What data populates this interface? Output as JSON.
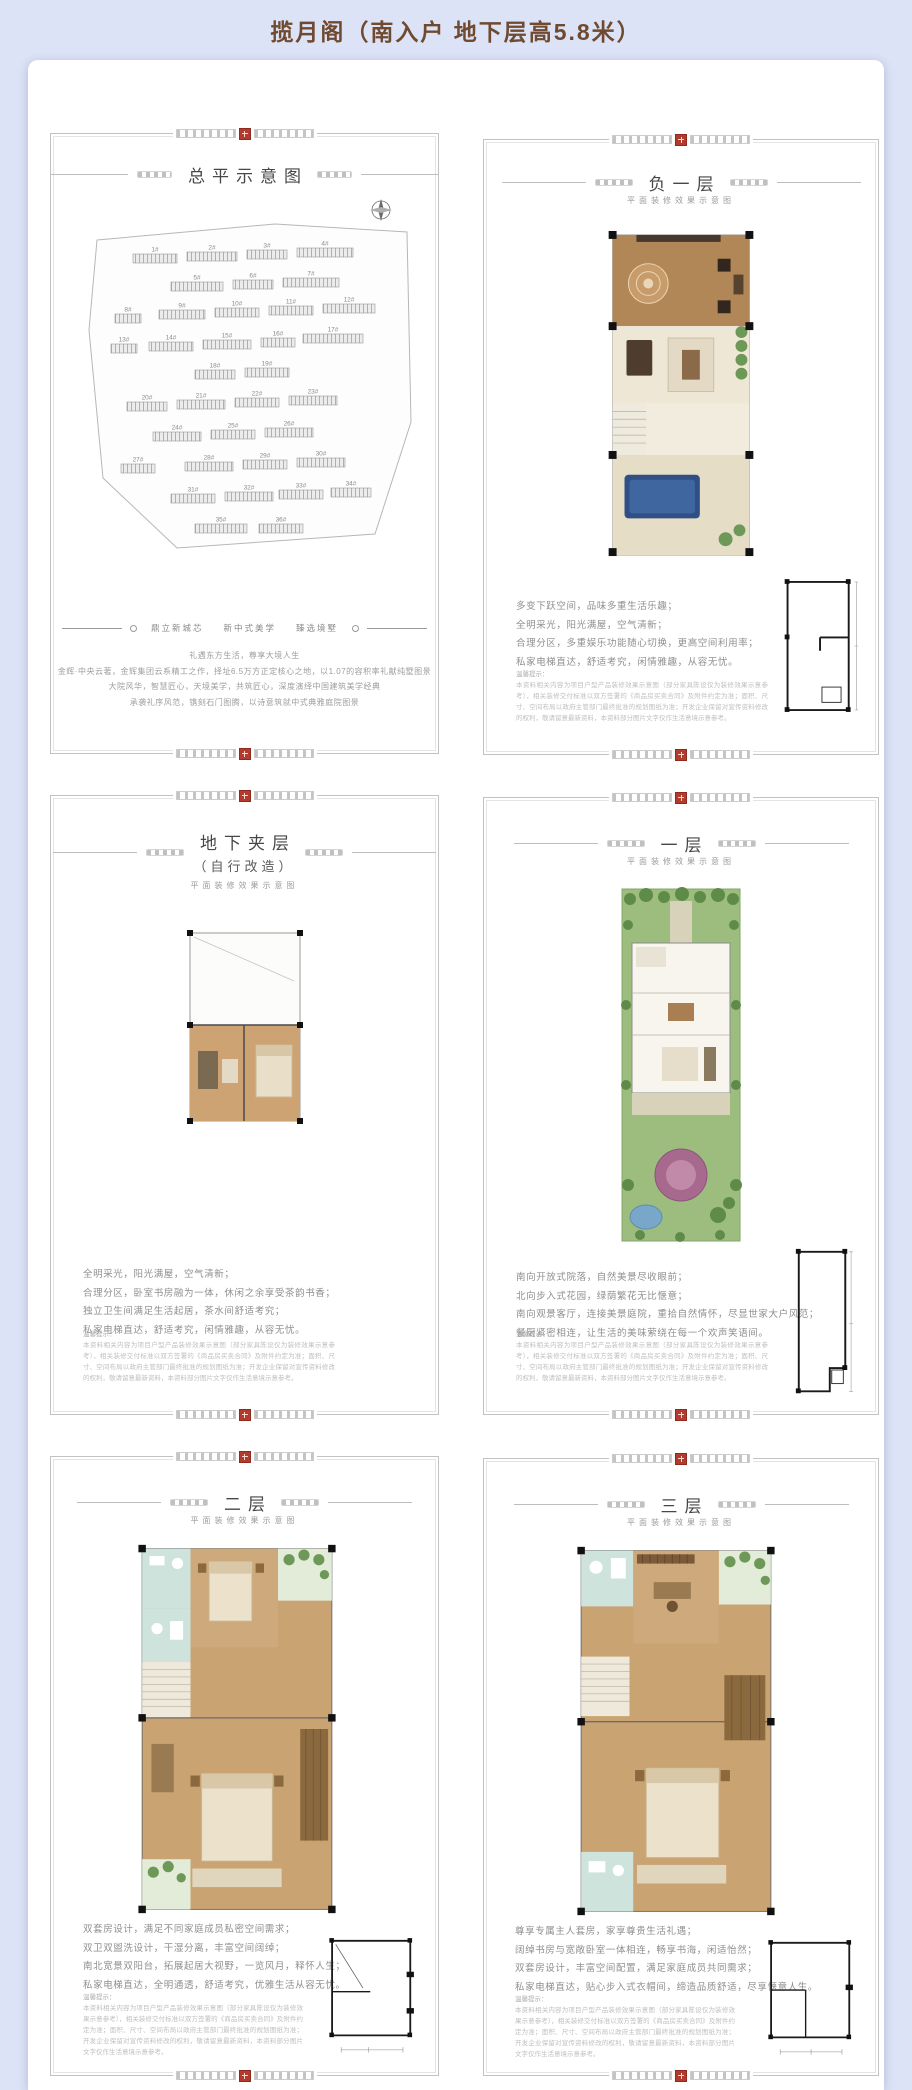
{
  "page": {
    "header_title": "揽月阁（南入户 地下层高5.8米）"
  },
  "colors": {
    "background_lavender": "#dce3f6",
    "header_brown": "#6f4a31",
    "seal_red": "#b23b2e",
    "panel_border_gray": "#c2c2c2",
    "pool_blue": "#2f4f86",
    "garden_green": "#9dbd7f"
  },
  "common": {
    "plan_subtitle": "平面装修效果示意图",
    "notice_title": "温馨提示：",
    "notice_body": "本资料相关内容为项目户型产品装修效果示意图（部分家具陈设仅为装修效果示意参考），相关装修交付标准以双方签署的《商品房买卖合同》及附件约定为准；面积、尺寸、空间布局以政府主管部门最终批准的规划图纸为准；开发企业保留对宣传资料修改的权利，敬请留意最新资料，本资料部分图片文字仅作生活意境示意参考。"
  },
  "site_plan": {
    "title": "总平示意图",
    "compass": "compass-rose-icon",
    "tagline": [
      "鼎立新城芯",
      "新中式美学",
      "臻选境墅"
    ],
    "paragraph": [
      "礼遇东方生活，尊享大境人生",
      "金辉·中央云著，金辉集团云系精工之作，择址6.5万方正定核心之地，以1.07的容积率礼献纯墅图景",
      "大院风华，智慧匠心，天境美学，共筑匠心，深度演绎中国建筑美学经典",
      "承袭礼序风范，镌刻石门图腾，以诗意筑就中式典雅庭院图景"
    ],
    "buildings": [
      {
        "label": "1#",
        "x": 58,
        "y": 72,
        "w": 44
      },
      {
        "label": "2#",
        "x": 112,
        "y": 70,
        "w": 50
      },
      {
        "label": "3#",
        "x": 172,
        "y": 68,
        "w": 40
      },
      {
        "label": "4#",
        "x": 222,
        "y": 66,
        "w": 56
      },
      {
        "label": "5#",
        "x": 96,
        "y": 100,
        "w": 52
      },
      {
        "label": "6#",
        "x": 158,
        "y": 98,
        "w": 40
      },
      {
        "label": "7#",
        "x": 208,
        "y": 96,
        "w": 56
      },
      {
        "label": "8#",
        "x": 40,
        "y": 132,
        "w": 26
      },
      {
        "label": "9#",
        "x": 84,
        "y": 128,
        "w": 46
      },
      {
        "label": "10#",
        "x": 140,
        "y": 126,
        "w": 44
      },
      {
        "label": "11#",
        "x": 194,
        "y": 124,
        "w": 44
      },
      {
        "label": "12#",
        "x": 248,
        "y": 122,
        "w": 52
      },
      {
        "label": "13#",
        "x": 36,
        "y": 162,
        "w": 26
      },
      {
        "label": "14#",
        "x": 74,
        "y": 160,
        "w": 44
      },
      {
        "label": "15#",
        "x": 128,
        "y": 158,
        "w": 48
      },
      {
        "label": "16#",
        "x": 186,
        "y": 156,
        "w": 34
      },
      {
        "label": "17#",
        "x": 228,
        "y": 152,
        "w": 60
      },
      {
        "label": "18#",
        "x": 120,
        "y": 188,
        "w": 40
      },
      {
        "label": "19#",
        "x": 170,
        "y": 186,
        "w": 44
      },
      {
        "label": "20#",
        "x": 52,
        "y": 220,
        "w": 40
      },
      {
        "label": "21#",
        "x": 102,
        "y": 218,
        "w": 48
      },
      {
        "label": "22#",
        "x": 160,
        "y": 216,
        "w": 44
      },
      {
        "label": "23#",
        "x": 214,
        "y": 214,
        "w": 48
      },
      {
        "label": "24#",
        "x": 78,
        "y": 250,
        "w": 48
      },
      {
        "label": "25#",
        "x": 136,
        "y": 248,
        "w": 44
      },
      {
        "label": "26#",
        "x": 190,
        "y": 246,
        "w": 48
      },
      {
        "label": "27#",
        "x": 46,
        "y": 282,
        "w": 34
      },
      {
        "label": "28#",
        "x": 110,
        "y": 280,
        "w": 48
      },
      {
        "label": "29#",
        "x": 168,
        "y": 278,
        "w": 44
      },
      {
        "label": "30#",
        "x": 222,
        "y": 276,
        "w": 48
      },
      {
        "label": "31#",
        "x": 96,
        "y": 312,
        "w": 44
      },
      {
        "label": "32#",
        "x": 150,
        "y": 310,
        "w": 48
      },
      {
        "label": "33#",
        "x": 204,
        "y": 308,
        "w": 44
      },
      {
        "label": "34#",
        "x": 256,
        "y": 306,
        "w": 40
      },
      {
        "label": "35#",
        "x": 120,
        "y": 342,
        "w": 52
      },
      {
        "label": "36#",
        "x": 184,
        "y": 342,
        "w": 44
      }
    ]
  },
  "floors": {
    "b1": {
      "title": "负一层",
      "lines": [
        "多变下跃空间，品味多重生活乐趣；",
        "全明采光，阳光满屋，空气清新；",
        "合理分区，多重娱乐功能随心切换，更高空间利用率；",
        "私家电梯直达，舒适考究，闲情雅趣，从容无忧。"
      ]
    },
    "mezz": {
      "title": "地下夹层",
      "subtitle2": "（自行改造）",
      "lines": [
        "全明采光，阳光满屋，空气清新；",
        "合理分区，卧室书房融为一体，休闲之余享受茶韵书香；",
        "独立卫生间满足生活起居，茶水间舒适考究；",
        "私家电梯直达，舒适考究，闲情雅趣，从容无忧。"
      ]
    },
    "f1": {
      "title": "一层",
      "lines": [
        "南向开放式院落，自然美景尽收眼前；",
        "北向步入式花园，绿荫繁花无比惬意；",
        "南向观景客厅，连接美景庭院，重拾自然情怀，尽显世家大户风范；",
        "餐厨紧密相连，让生活的美味萦绕在每一个欢声笑语间。"
      ]
    },
    "f2": {
      "title": "二层",
      "lines": [
        "双套房设计，满足不同家庭成员私密空间需求；",
        "双卫双盥洗设计，干湿分离，丰富空间阔绰；",
        "南北宽景双阳台，拓展起居大视野，一览风月，释怀人生；",
        "私家电梯直达，全明通透，舒适考究，优雅生活从容无忧。"
      ]
    },
    "f3": {
      "title": "三层",
      "lines": [
        "尊享专属主人套房，家享尊贵生活礼遇；",
        "阔绰书房与宽敞卧室一体相连，畅享书海，闲适怡然；",
        "双套房设计，丰富空间配置，满足家庭成员共同需求；",
        "私家电梯直达，贴心步入式衣帽间，缔造品质舒适，尽享惬意人生。"
      ]
    }
  }
}
